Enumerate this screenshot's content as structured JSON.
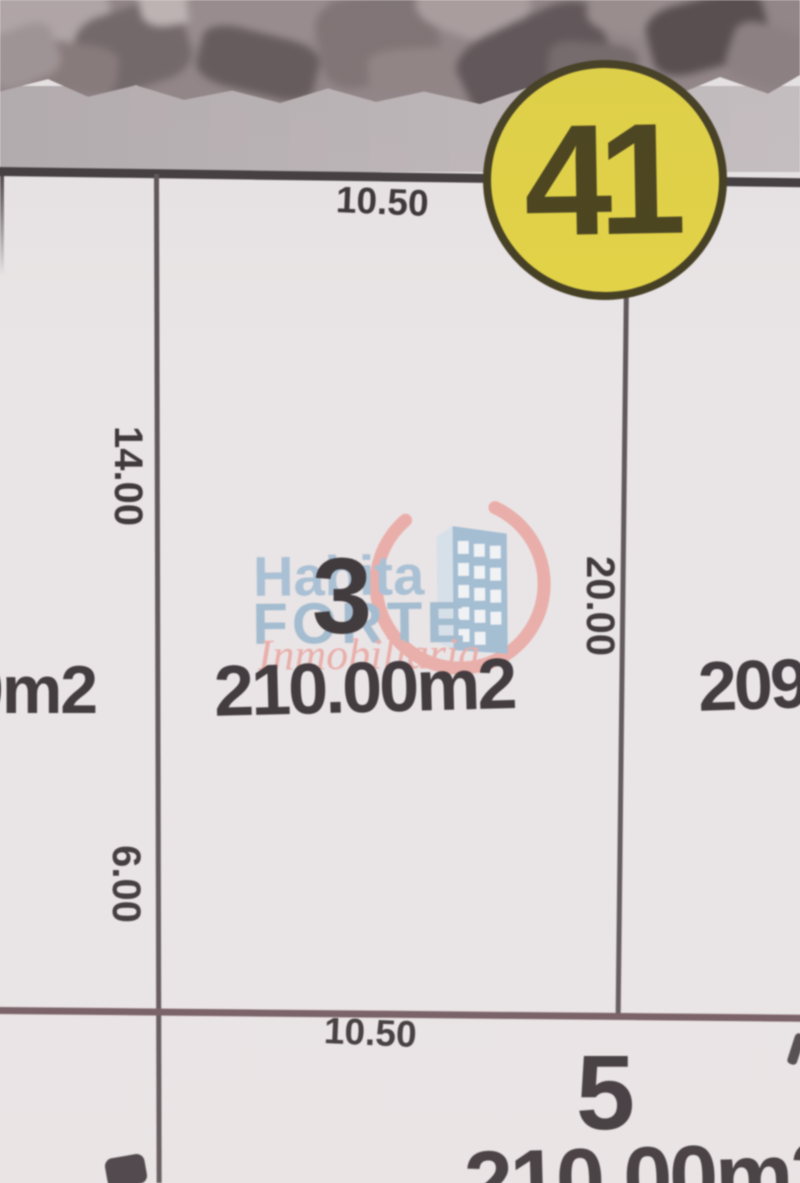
{
  "map": {
    "block_number": "41",
    "street_front_dimension": "10.50",
    "lot_3": {
      "number": "3",
      "area": "210.00m2",
      "left_side_upper_dimension": "14.00",
      "left_side_lower_dimension": "6.00",
      "right_side_dimension": "20.00",
      "rear_dimension": "10.50"
    },
    "lot_left_partial_area": "0m2",
    "lot_right_partial_area": "209",
    "lot_5": {
      "number": "5",
      "partial_area": "210.00m2"
    },
    "colors": {
      "badge_fill": "#e4d43e",
      "badge_border": "#3c3618",
      "badge_text": "#423b12",
      "ink": "#332d30",
      "boundary_line": "#574f52",
      "rear_line": "#6d545a",
      "street_band": "#bbb4b6",
      "paper": "#e9e5e6"
    }
  },
  "watermark": {
    "brand_line1": "Habita",
    "brand_line2": "FORTE",
    "brand_line3": "Inmobiliaria",
    "blue": "#a3bed4",
    "salmon": "#eba9a4"
  }
}
